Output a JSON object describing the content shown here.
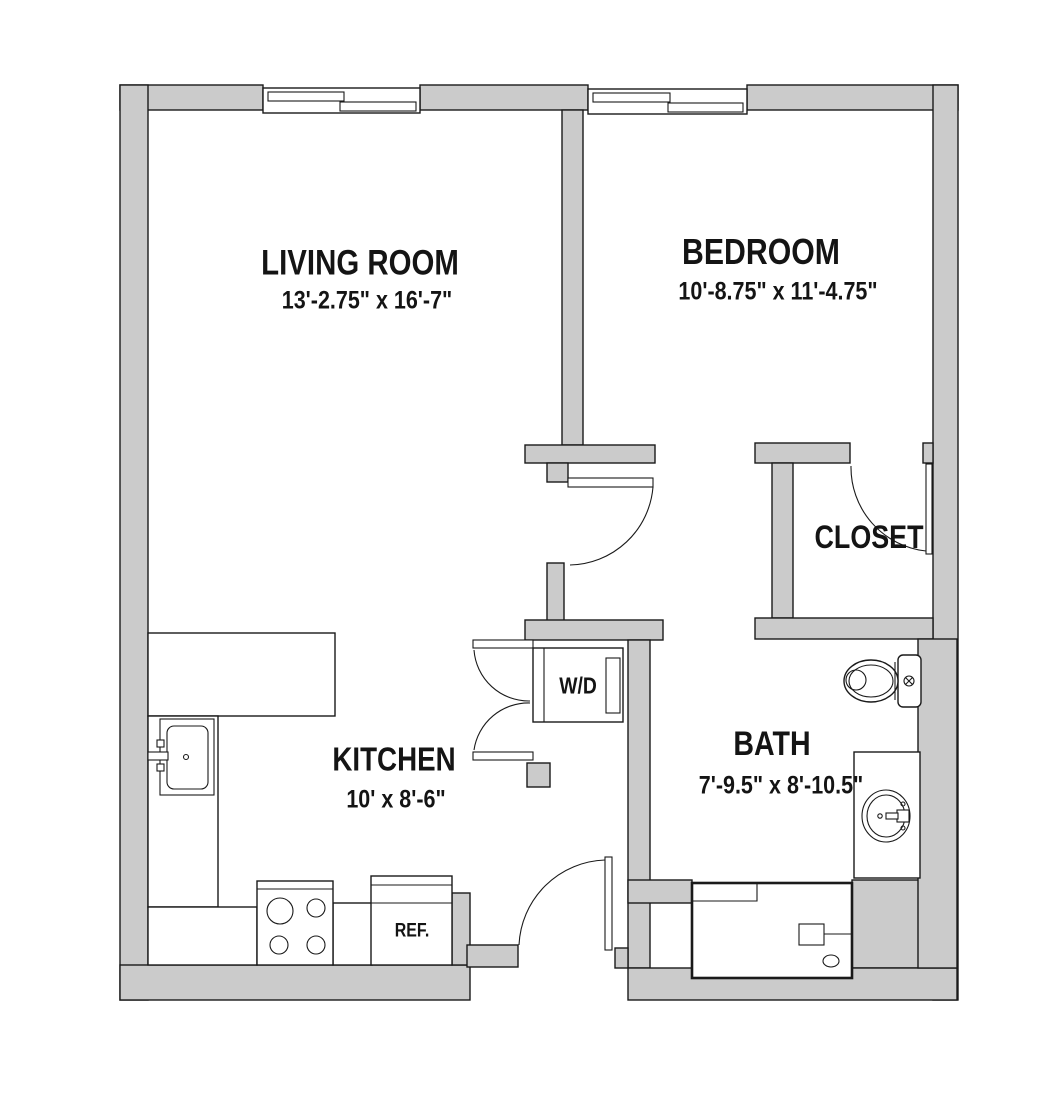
{
  "colors": {
    "wall_fill": "#cbcbcb",
    "line": "#1a1a1a",
    "floor": "#ffffff"
  },
  "rooms": [
    {
      "name": "living-room",
      "label": "LIVING ROOM",
      "dimensions": "13'-2.75\" x 16'-7\""
    },
    {
      "name": "bedroom",
      "label": "BEDROOM",
      "dimensions": "10'-8.75\" x 11'-4.75\""
    },
    {
      "name": "kitchen",
      "label": "KITCHEN",
      "dimensions": "10' x 8'-6\""
    },
    {
      "name": "bath",
      "label": "BATH",
      "dimensions": "7'-9.5\" x 8'-10.5\""
    },
    {
      "name": "closet",
      "label": "CLOSET"
    }
  ],
  "fixtures": [
    {
      "name": "washer-dryer",
      "label": "W/D"
    },
    {
      "name": "refrigerator",
      "label": "REF."
    }
  ]
}
